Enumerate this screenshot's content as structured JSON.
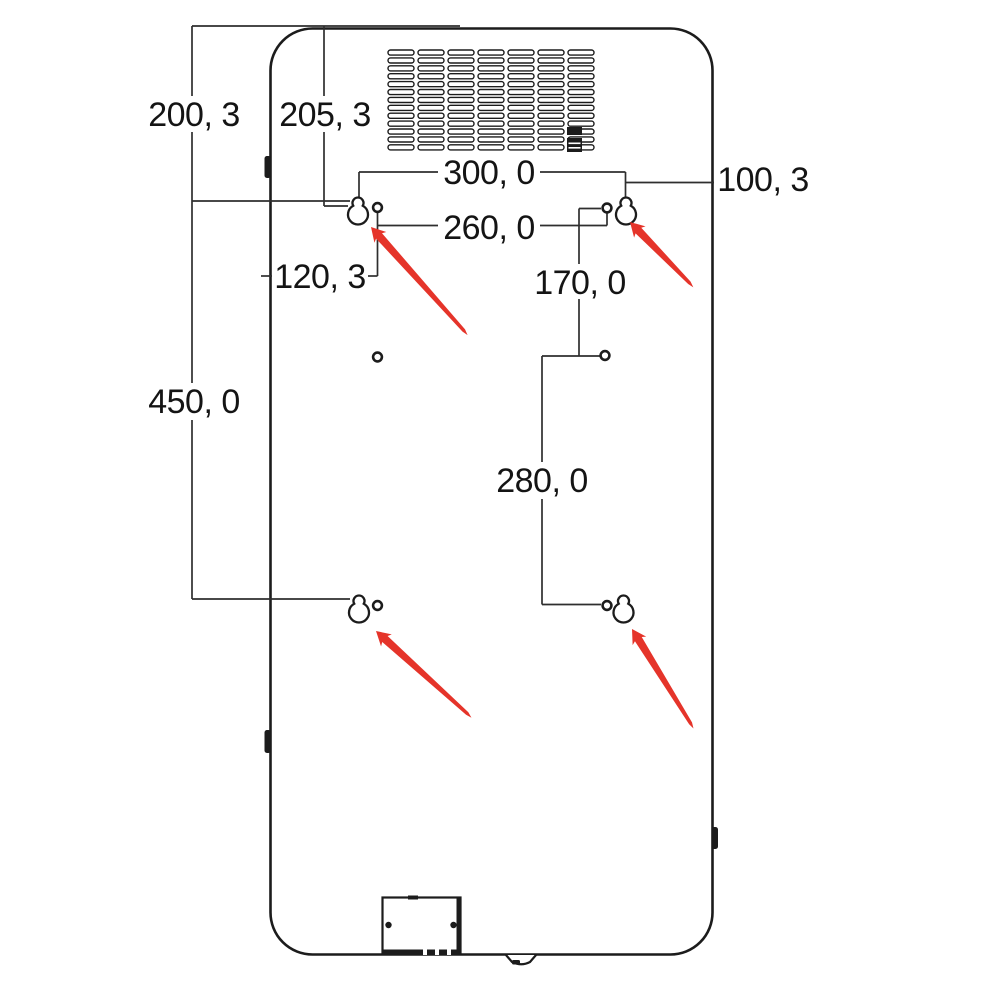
{
  "diagram": {
    "type": "technical-drawing",
    "dimension_labels": [
      {
        "id": "200-3",
        "text": "200, 3"
      },
      {
        "id": "205-3",
        "text": "205, 3"
      },
      {
        "id": "300-0",
        "text": "300, 0"
      },
      {
        "id": "100-3",
        "text": "100, 3"
      },
      {
        "id": "260-0",
        "text": "260, 0"
      },
      {
        "id": "120-3",
        "text": "120, 3"
      },
      {
        "id": "170-0",
        "text": "170, 0"
      },
      {
        "id": "450-0",
        "text": "450, 0"
      },
      {
        "id": "280-0",
        "text": "280, 0"
      }
    ],
    "icons": {
      "keyhole_slots": "keyhole-mount-slot",
      "screw_holes": "screw-hole",
      "arrows": "red-pointer-arrow",
      "vent": "vent-grille"
    },
    "colors": {
      "line": "#1c1c1c",
      "dimension_line": "#2e2e2e",
      "arrow": "#e5342a",
      "background": "#ffffff"
    }
  }
}
